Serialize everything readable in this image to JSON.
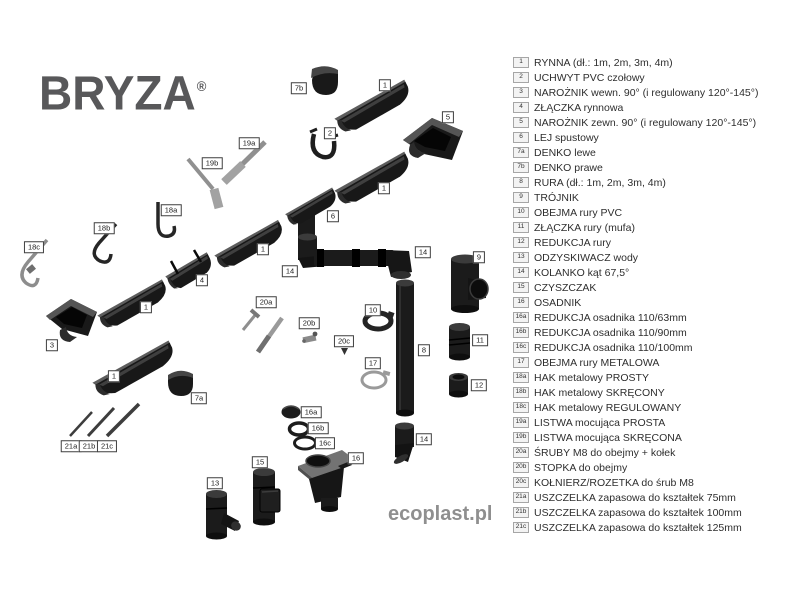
{
  "brand": {
    "name": "BRYZA",
    "reg": "®"
  },
  "watermark": "ecoplast.pl",
  "colors": {
    "part_body": "#1b1b1b",
    "part_rim": "#5d5d5d",
    "metal": "#8f8f8f",
    "logo": "#58585a",
    "legend_text": "#2e2e2e",
    "label_border": "#3f3f3f"
  },
  "legend": {
    "items": [
      {
        "num": "1",
        "label": "RYNNA (dł.: 1m, 2m, 3m, 4m)"
      },
      {
        "num": "2",
        "label": "UCHWYT PVC czołowy"
      },
      {
        "num": "3",
        "label": "NAROŻNIK wewn. 90° (i regulowany 120°-145°)"
      },
      {
        "num": "4",
        "label": "ZŁĄCZKA rynnowa"
      },
      {
        "num": "5",
        "label": "NAROŻNIK zewn. 90° (i regulowany 120°-145°)"
      },
      {
        "num": "6",
        "label": "LEJ spustowy"
      },
      {
        "num": "7a",
        "label": "DENKO lewe"
      },
      {
        "num": "7b",
        "label": "DENKO prawe"
      },
      {
        "num": "8",
        "label": "RURA (dł.: 1m, 2m, 3m, 4m)"
      },
      {
        "num": "9",
        "label": "TRÓJNIK"
      },
      {
        "num": "10",
        "label": "OBEJMA rury PVC"
      },
      {
        "num": "11",
        "label": "ZŁĄCZKA rury (mufa)"
      },
      {
        "num": "12",
        "label": "REDUKCJA rury"
      },
      {
        "num": "13",
        "label": "ODZYSKIWACZ wody"
      },
      {
        "num": "14",
        "label": "KOLANKO kąt 67,5°"
      },
      {
        "num": "15",
        "label": "CZYSZCZAK"
      },
      {
        "num": "16",
        "label": "OSADNIK"
      },
      {
        "num": "16a",
        "label": "REDUKCJA osadnika 110/63mm"
      },
      {
        "num": "16b",
        "label": "REDUKCJA osadnika 110/90mm"
      },
      {
        "num": "16c",
        "label": "REDUKCJA osadnika 110/100mm"
      },
      {
        "num": "17",
        "label": "OBEJMA rury METALOWA"
      },
      {
        "num": "18a",
        "label": "HAK metalowy PROSTY"
      },
      {
        "num": "18b",
        "label": "HAK metalowy SKRĘCONY"
      },
      {
        "num": "18c",
        "label": "HAK metalowy REGULOWANY"
      },
      {
        "num": "19a",
        "label": "LISTWA mocująca PROSTA"
      },
      {
        "num": "19b",
        "label": "LISTWA mocująca SKRĘCONA"
      },
      {
        "num": "20a",
        "label": "ŚRUBY M8 do obejmy + kołek"
      },
      {
        "num": "20b",
        "label": "STOPKA do obejmy"
      },
      {
        "num": "20c",
        "label": "KOŁNIERZ/ROZETKA do śrub M8"
      },
      {
        "num": "21a",
        "label": "USZCZELKA zapasowa do kształtek 75mm"
      },
      {
        "num": "21b",
        "label": "USZCZELKA zapasowa do kształtek 100mm"
      },
      {
        "num": "21c",
        "label": "USZCZELKA zapasowa do kształtek 125mm"
      }
    ]
  },
  "diagram": {
    "labels": [
      {
        "num": "7b",
        "x": 299,
        "y": 88
      },
      {
        "num": "1",
        "x": 385,
        "y": 85
      },
      {
        "num": "5",
        "x": 448,
        "y": 117
      },
      {
        "num": "2",
        "x": 330,
        "y": 133
      },
      {
        "num": "19a",
        "x": 249,
        "y": 143
      },
      {
        "num": "19b",
        "x": 212,
        "y": 163
      },
      {
        "num": "1",
        "x": 384,
        "y": 188
      },
      {
        "num": "18a",
        "x": 171,
        "y": 210
      },
      {
        "num": "6",
        "x": 333,
        "y": 216
      },
      {
        "num": "18b",
        "x": 104,
        "y": 228
      },
      {
        "num": "18c",
        "x": 34,
        "y": 247
      },
      {
        "num": "1",
        "x": 263,
        "y": 249
      },
      {
        "num": "14",
        "x": 423,
        "y": 252
      },
      {
        "num": "9",
        "x": 479,
        "y": 257
      },
      {
        "num": "14",
        "x": 290,
        "y": 271
      },
      {
        "num": "4",
        "x": 202,
        "y": 280
      },
      {
        "num": "20a",
        "x": 266,
        "y": 302
      },
      {
        "num": "1",
        "x": 146,
        "y": 307
      },
      {
        "num": "10",
        "x": 373,
        "y": 310
      },
      {
        "num": "20b",
        "x": 309,
        "y": 323
      },
      {
        "num": "11",
        "x": 480,
        "y": 340
      },
      {
        "num": "20c",
        "x": 344,
        "y": 341
      },
      {
        "num": "3",
        "x": 52,
        "y": 345
      },
      {
        "num": "8",
        "x": 424,
        "y": 350
      },
      {
        "num": "17",
        "x": 373,
        "y": 363
      },
      {
        "num": "1",
        "x": 114,
        "y": 376
      },
      {
        "num": "12",
        "x": 479,
        "y": 385
      },
      {
        "num": "7a",
        "x": 199,
        "y": 398
      },
      {
        "num": "16a",
        "x": 311,
        "y": 412
      },
      {
        "num": "16b",
        "x": 318,
        "y": 428
      },
      {
        "num": "14",
        "x": 424,
        "y": 439
      },
      {
        "num": "16c",
        "x": 325,
        "y": 443
      },
      {
        "num": "21a",
        "x": 71,
        "y": 446
      },
      {
        "num": "21b",
        "x": 89,
        "y": 446
      },
      {
        "num": "21c",
        "x": 107,
        "y": 446
      },
      {
        "num": "16",
        "x": 356,
        "y": 458
      },
      {
        "num": "15",
        "x": 260,
        "y": 462
      },
      {
        "num": "13",
        "x": 215,
        "y": 483
      }
    ]
  }
}
